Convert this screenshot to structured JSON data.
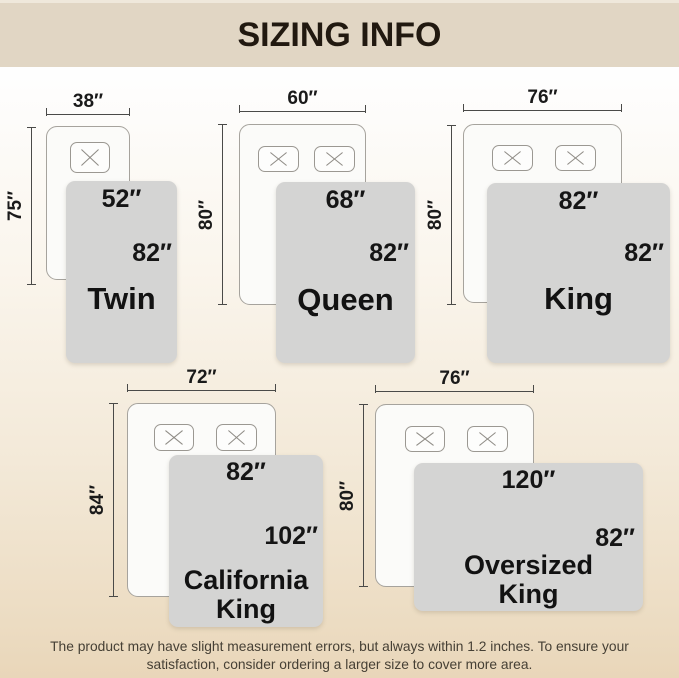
{
  "header": {
    "title": "SIZING INFO"
  },
  "diagrams": [
    {
      "name": "Twin",
      "bed_width": "38″",
      "bed_length": "75″",
      "blanket_width": "52″",
      "blanket_length": "82″",
      "pillows": 1
    },
    {
      "name": "Queen",
      "bed_width": "60″",
      "bed_length": "80″",
      "blanket_width": "68″",
      "blanket_length": "82″",
      "pillows": 2
    },
    {
      "name": "King",
      "bed_width": "76″",
      "bed_length": "80″",
      "blanket_width": "82″",
      "blanket_length": "82″",
      "pillows": 2
    },
    {
      "name": "California\nKing",
      "bed_width": "72″",
      "bed_length": "84″",
      "blanket_width": "82″",
      "blanket_length": "102″",
      "pillows": 2
    },
    {
      "name": "Oversized\nKing",
      "bed_width": "76″",
      "bed_length": "80″",
      "blanket_width": "120″",
      "blanket_length": "82″",
      "pillows": 2
    }
  ],
  "footer": {
    "disclaimer": "The product may have slight measurement errors, but always within 1.2 inches. To ensure your\nsatisfaction, consider ordering a larger size to cover more area."
  },
  "colors": {
    "header_bg": "#e1d6c4",
    "blanket_gray": "#d4d4d3",
    "background_bottom": "#ecdcc2",
    "text_dark": "#1a1a1a"
  }
}
